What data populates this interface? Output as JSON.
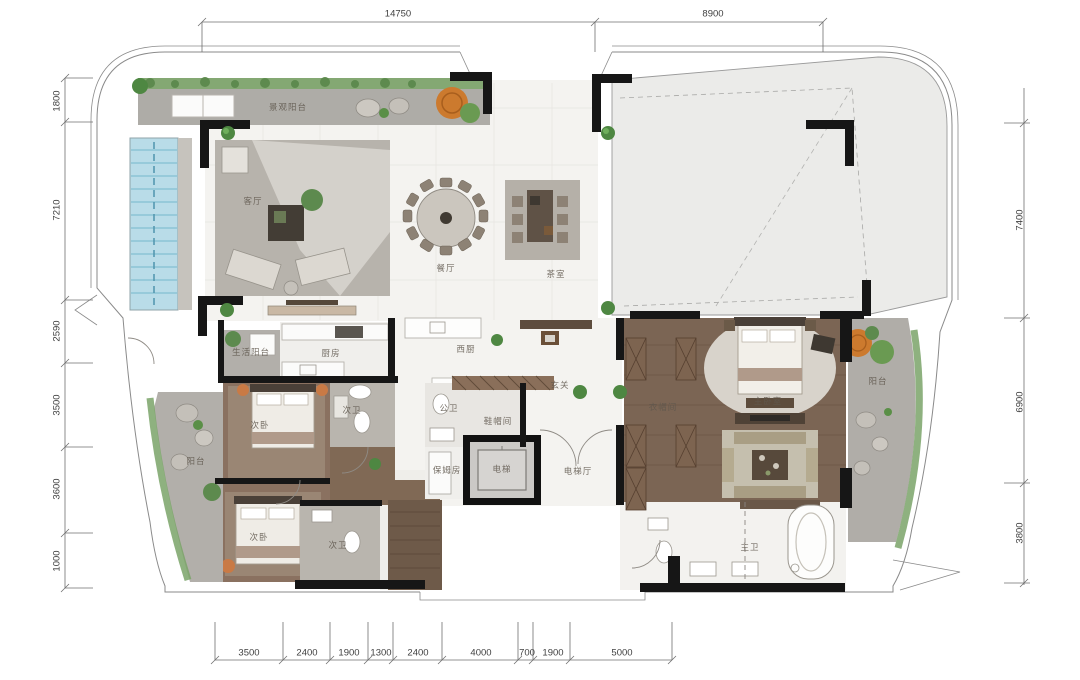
{
  "drawing": {
    "type": "residential-floor-plan",
    "units": "mm",
    "colors": {
      "wall": "#161616",
      "marble_floor": "#f4f3f0",
      "wood_floor": "#7b6554",
      "terrace_grey": "#aeaca7",
      "pool_blue": "#b9dce8",
      "greenery": "#5a8f47",
      "orange_tree": "#cc7a2e",
      "dim_line": "#6f6f6f"
    }
  },
  "dimensions": {
    "top": [
      {
        "id": "top-width-left",
        "label": "14750",
        "x": 398,
        "y": 14
      },
      {
        "id": "top-width-right",
        "label": "8900",
        "x": 713,
        "y": 14
      }
    ],
    "left": [
      {
        "id": "left-1",
        "label": "1800",
        "x": 57,
        "y": 101
      },
      {
        "id": "left-2",
        "label": "7210",
        "x": 57,
        "y": 210
      },
      {
        "id": "left-3",
        "label": "2590",
        "x": 57,
        "y": 331
      },
      {
        "id": "left-4",
        "label": "3500",
        "x": 57,
        "y": 405
      },
      {
        "id": "left-5",
        "label": "3600",
        "x": 57,
        "y": 489
      },
      {
        "id": "left-6",
        "label": "1000",
        "x": 57,
        "y": 561
      }
    ],
    "right": [
      {
        "id": "right-1",
        "label": "7400",
        "x": 1020,
        "y": 220
      },
      {
        "id": "right-2",
        "label": "6900",
        "x": 1020,
        "y": 402
      },
      {
        "id": "right-3",
        "label": "3800",
        "x": 1020,
        "y": 533
      }
    ],
    "bottom": [
      {
        "id": "bottom-1",
        "label": "3500",
        "x": 249,
        "y": 653
      },
      {
        "id": "bottom-2",
        "label": "2400",
        "x": 307,
        "y": 653
      },
      {
        "id": "bottom-3",
        "label": "1900",
        "x": 349,
        "y": 653
      },
      {
        "id": "bottom-4",
        "label": "1300",
        "x": 381,
        "y": 653
      },
      {
        "id": "bottom-5",
        "label": "2400",
        "x": 418,
        "y": 653
      },
      {
        "id": "bottom-6",
        "label": "4000",
        "x": 481,
        "y": 653
      },
      {
        "id": "bottom-7",
        "label": "700",
        "x": 527,
        "y": 653
      },
      {
        "id": "bottom-8",
        "label": "1900",
        "x": 553,
        "y": 653
      },
      {
        "id": "bottom-9",
        "label": "5000",
        "x": 622,
        "y": 653
      }
    ]
  },
  "rooms": [
    {
      "id": "view-terrace",
      "label": "景观阳台",
      "x": 288,
      "y": 107
    },
    {
      "id": "living-room",
      "label": "客厅",
      "x": 253,
      "y": 201
    },
    {
      "id": "dining-room",
      "label": "餐厅",
      "x": 446,
      "y": 268
    },
    {
      "id": "tea-room",
      "label": "茶室",
      "x": 556,
      "y": 274
    },
    {
      "id": "utility-balcony",
      "label": "生活阳台",
      "x": 251,
      "y": 352
    },
    {
      "id": "kitchen",
      "label": "厨房",
      "x": 331,
      "y": 353
    },
    {
      "id": "west-kitchen",
      "label": "西厨",
      "x": 466,
      "y": 349
    },
    {
      "id": "foyer",
      "label": "玄关",
      "x": 560,
      "y": 385
    },
    {
      "id": "bedroom-2",
      "label": "次卧",
      "x": 260,
      "y": 425
    },
    {
      "id": "bath-2",
      "label": "次卫",
      "x": 352,
      "y": 410
    },
    {
      "id": "guest-bath",
      "label": "公卫",
      "x": 449,
      "y": 408
    },
    {
      "id": "cloakroom",
      "label": "鞋帽间",
      "x": 498,
      "y": 421
    },
    {
      "id": "maid-room",
      "label": "保姆房",
      "x": 447,
      "y": 470
    },
    {
      "id": "elevator",
      "label": "电梯",
      "x": 502,
      "y": 469
    },
    {
      "id": "elevator-hall",
      "label": "电梯厅",
      "x": 578,
      "y": 471
    },
    {
      "id": "walk-in-closet",
      "label": "衣帽间",
      "x": 663,
      "y": 407
    },
    {
      "id": "master-bedroom",
      "label": "主卧室",
      "x": 768,
      "y": 401
    },
    {
      "id": "balcony-right",
      "label": "阳台",
      "x": 878,
      "y": 381
    },
    {
      "id": "balcony-left",
      "label": "阳台",
      "x": 196,
      "y": 461
    },
    {
      "id": "bedroom-3",
      "label": "次卧",
      "x": 259,
      "y": 537
    },
    {
      "id": "bath-3",
      "label": "次卫",
      "x": 338,
      "y": 545
    },
    {
      "id": "master-bath",
      "label": "主卫",
      "x": 750,
      "y": 547
    }
  ]
}
